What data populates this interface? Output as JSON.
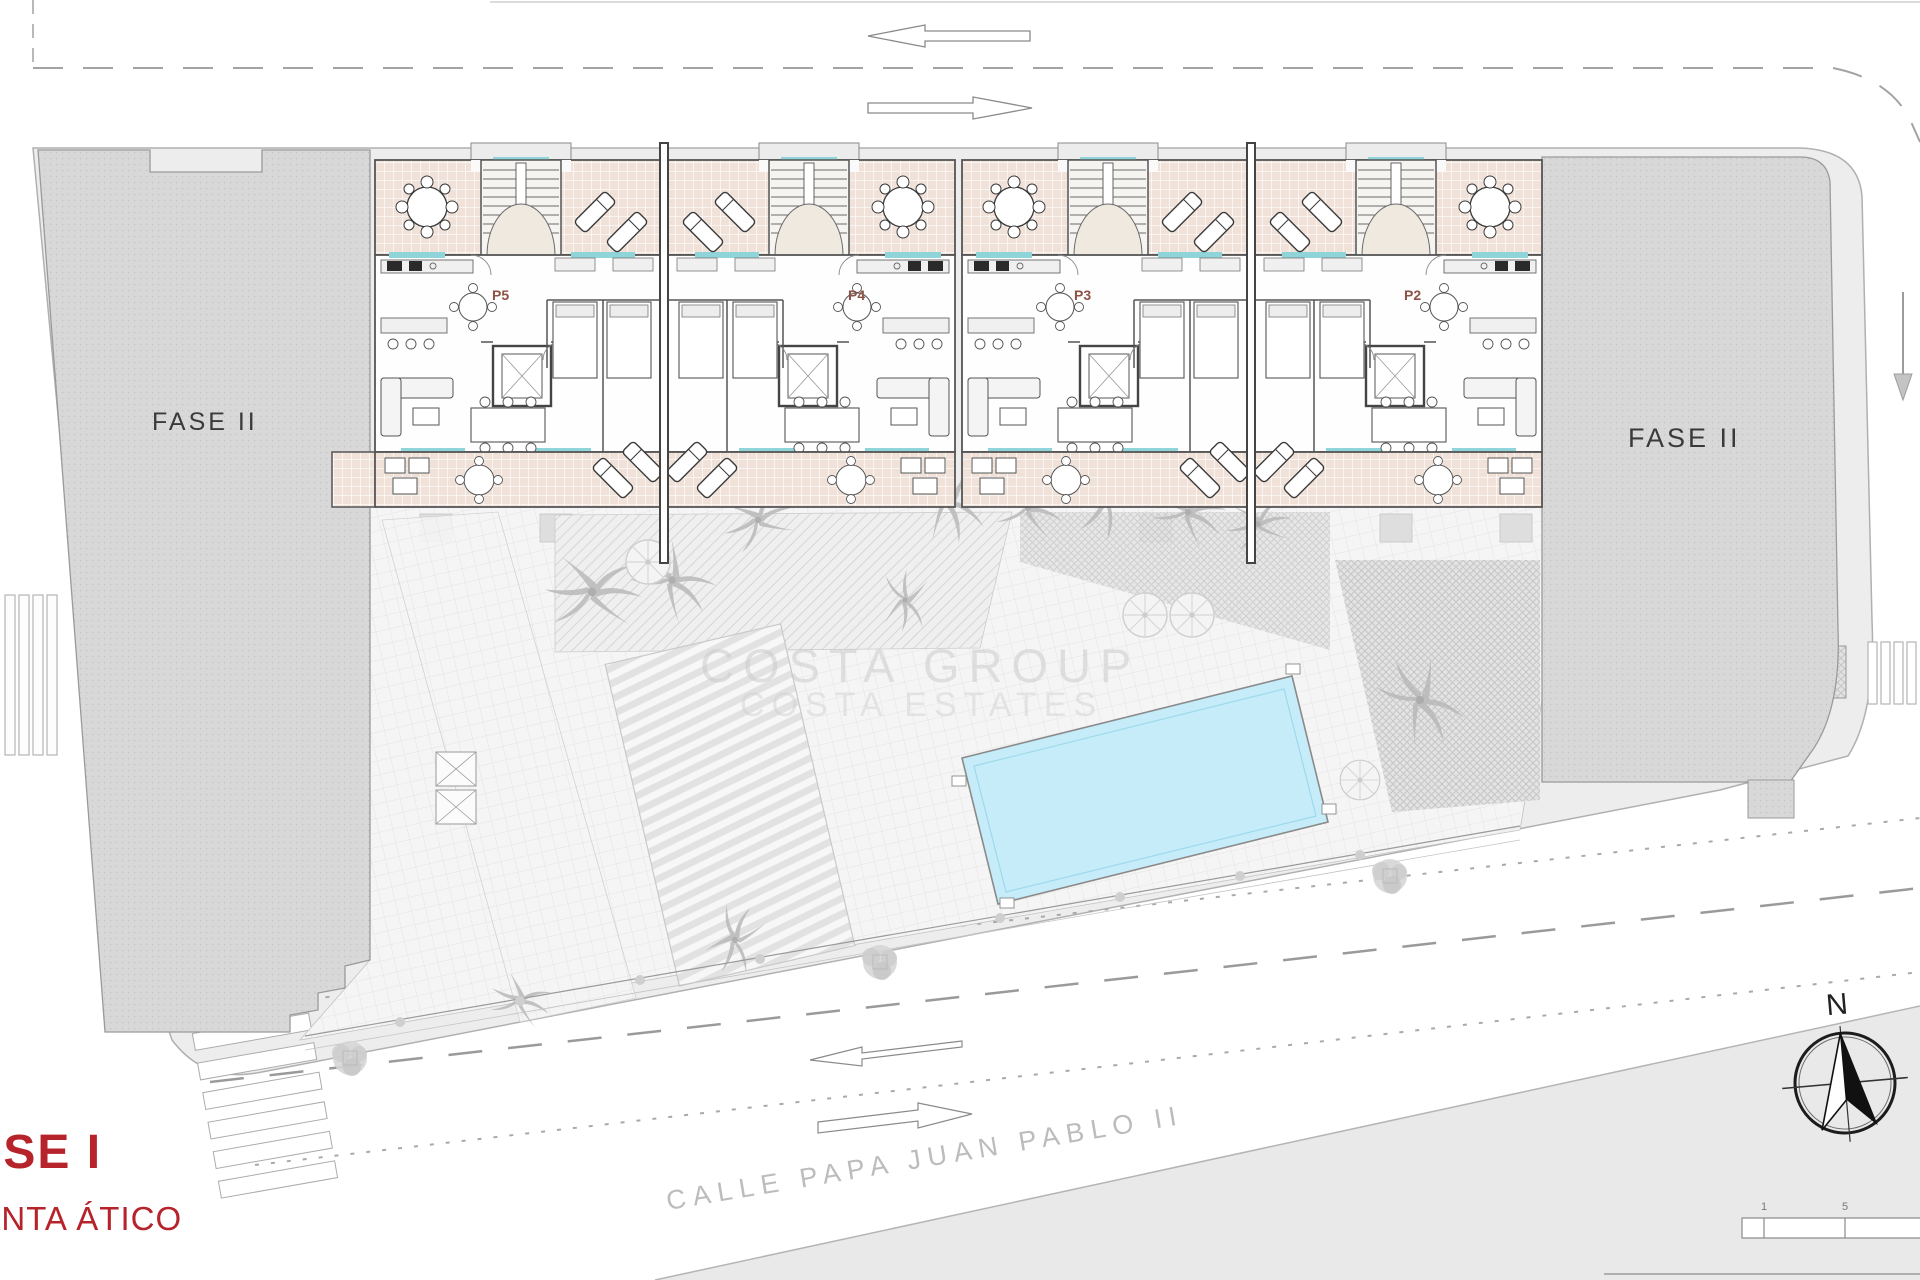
{
  "document": {
    "type": "architectural-site-plan",
    "phase": {
      "title": "FASE I",
      "subtitle": "PLANTA ÁTICO"
    },
    "blocks": {
      "fase_left": "FASE II",
      "fase_right": "FASE II"
    },
    "units": [
      {
        "label": "P5"
      },
      {
        "label": "P4"
      },
      {
        "label": "P3"
      },
      {
        "label": "P2"
      }
    ],
    "street": {
      "name": "CALLE PAPA JUAN PABLO II"
    },
    "watermark": {
      "line1": "COSTA GROUP",
      "line2": "COSTA ESTATES"
    },
    "compass": {
      "north": "N"
    },
    "scalebar": {
      "tick1": "1",
      "tick2": "5"
    },
    "colors": {
      "terrace_pink": "#f0e2d9",
      "pool_cyan": "#c5ecf8",
      "window_cyan": "#8fd4d8",
      "block_gray": "#d8d8d8",
      "sidewalk_gray": "#ededed",
      "wall_dark": "#555555",
      "phase_red": "#b6232b",
      "unit_label_brown": "#8d5245"
    }
  }
}
